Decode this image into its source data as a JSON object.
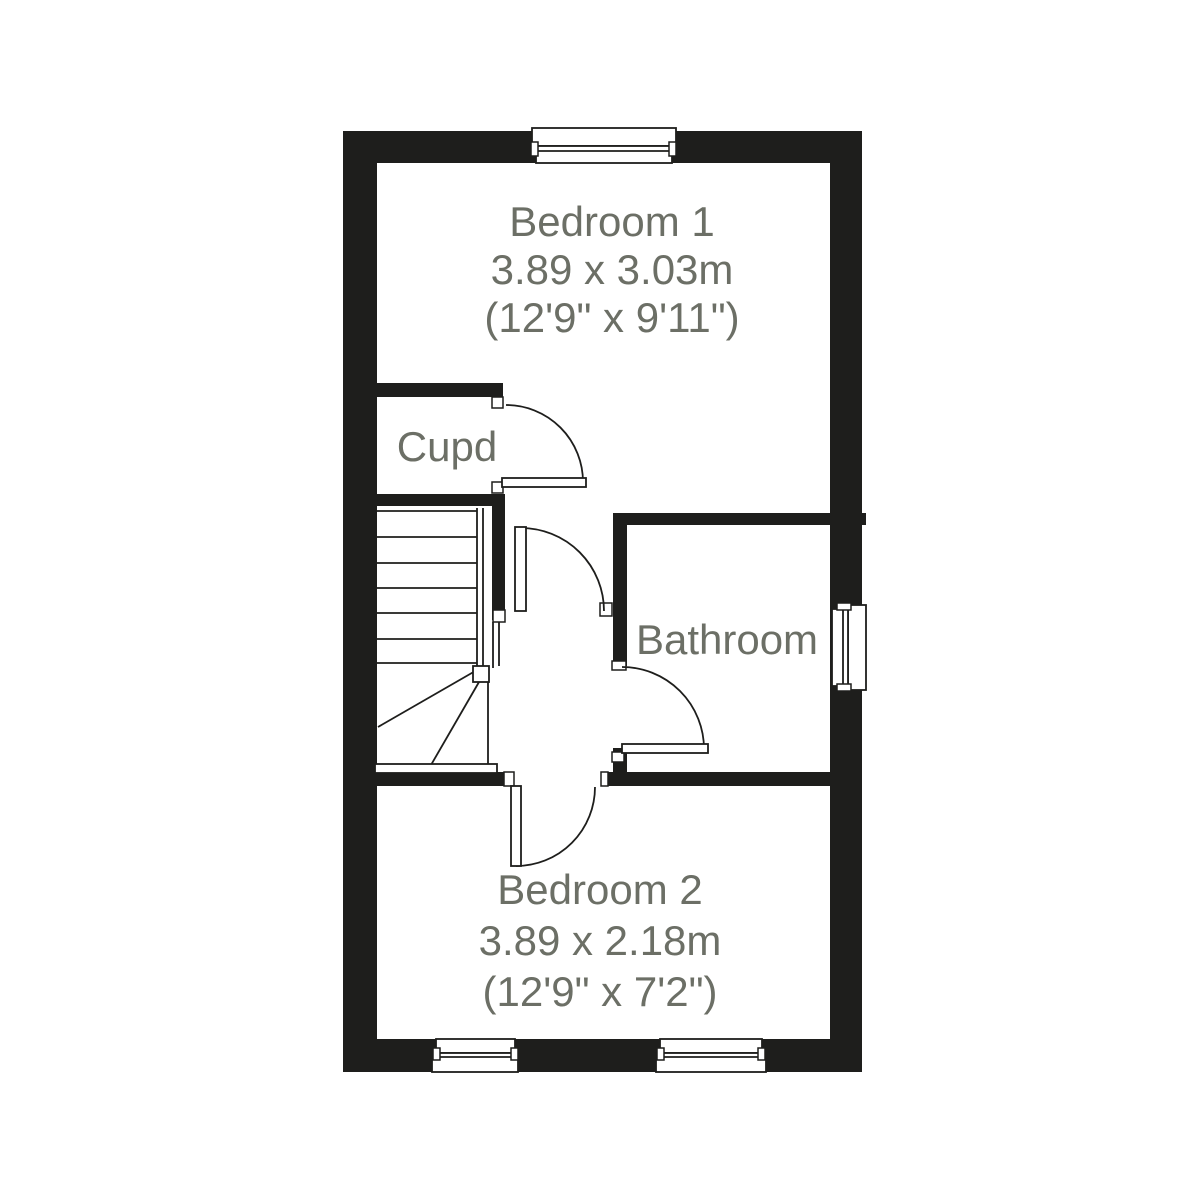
{
  "plan": {
    "title": "First floor plan",
    "colors": {
      "wall": "#1e1e1c",
      "line": "#1e1e1c",
      "label": "#6c6f66",
      "background": "#ffffff"
    },
    "rooms": {
      "bedroom1": {
        "name": "Bedroom 1",
        "size_metric": "3.89 x 3.03m",
        "size_imperial": "(12'9\" x 9'11\")"
      },
      "cupboard": {
        "name": "Cupd"
      },
      "bathroom": {
        "name": "Bathroom"
      },
      "bedroom2": {
        "name": "Bedroom 2",
        "size_metric": "3.89 x 2.18m",
        "size_imperial": "(12'9\" x 7'2\")"
      }
    },
    "features": {
      "stairs": "winder staircase",
      "windows": 4,
      "doors": 4
    }
  }
}
